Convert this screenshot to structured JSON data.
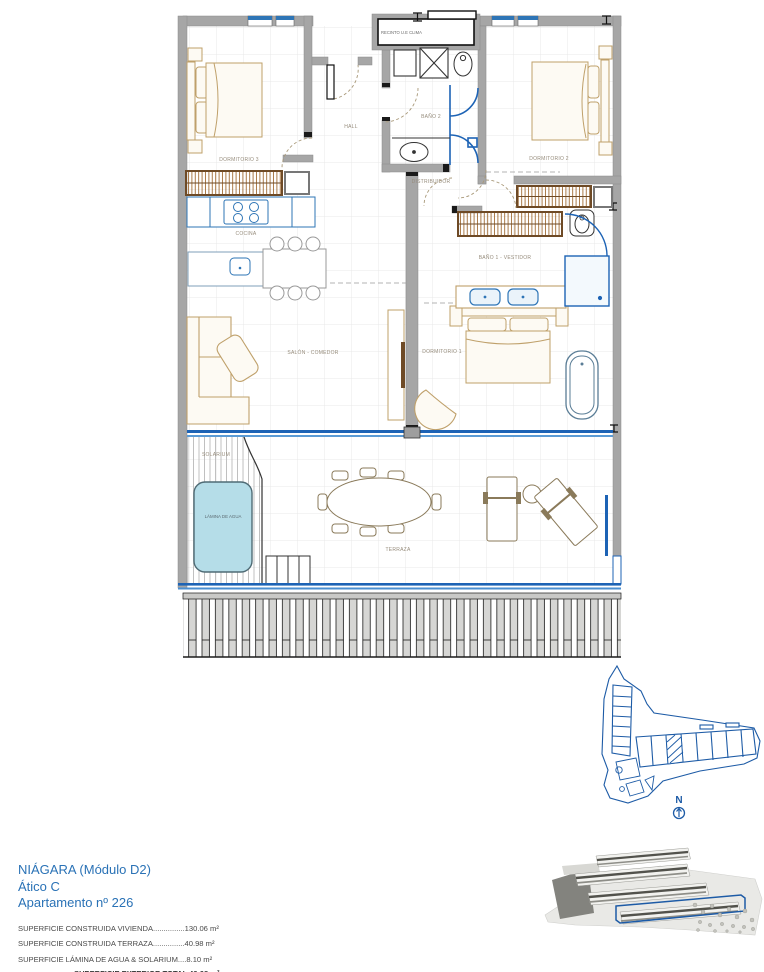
{
  "plan": {
    "labels": {
      "recinto": "RECINTO U.E CLIMA",
      "hall": "HALL",
      "bano2": "BAÑO 2",
      "dorm3": "DORMITORIO 3",
      "dorm2": "DORMITORIO 2",
      "distribuidor": "DISTRIBUIDOR",
      "cocina": "COCINA",
      "bano1": "BAÑO 1 - VESTIDOR",
      "salon": "SALÓN - COMEDOR",
      "dorm1": "DORMITORIO 1",
      "solarium": "SOLARIUM",
      "lamina": "LÁMINA DE AGUA",
      "terraza": "TERRAZA"
    },
    "compass_north": "N"
  },
  "info": {
    "project": "NIÁGARA (Módulo D2)",
    "floor": "Ático C",
    "apartment": "Apartamento nº 226",
    "area_lines": [
      "SUPERFICIE CONSTRUIDA VIVIENDA...............130.06 m²",
      "SUPERFICIE CONSTRUIDA TERRAZA...............40.98 m²",
      "SUPERFICIE LÁMINA DE AGUA & SOLARIUM....8.10 m²"
    ],
    "total_line": "SUPERFICIE EXTERIOR TOTAL 49.08 m²"
  },
  "colors": {
    "wall_gray": "#a6a6a6",
    "fixture_blue": "#2e75b6",
    "glazing_blue": "#1d63b5",
    "furniture_tan": "#bfa06a",
    "wardrobe_brown": "#6e4a26",
    "pool_fill": "#b5dde8",
    "site_plan_blue": "#1d5ba6",
    "title_blue": "#2a72b6"
  }
}
